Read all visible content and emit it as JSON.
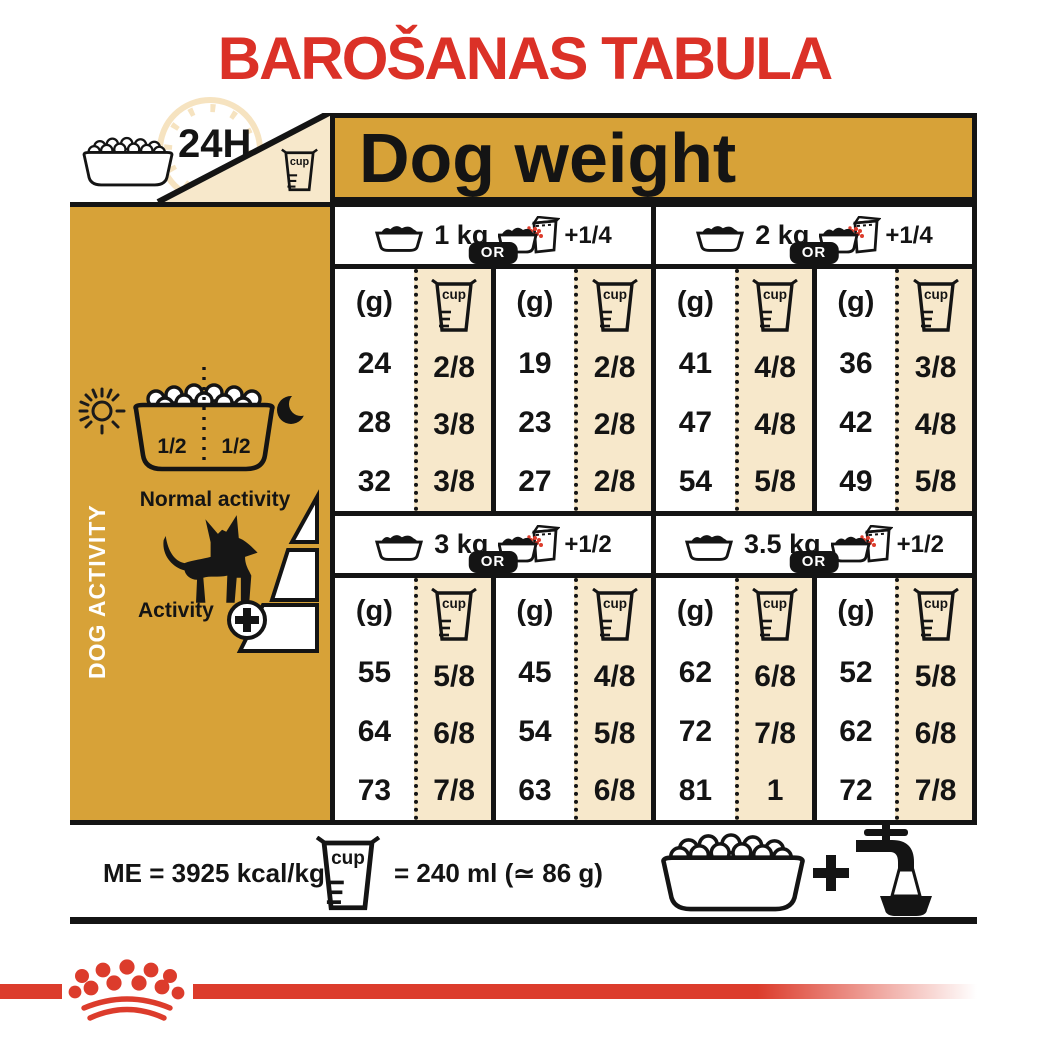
{
  "title": "BAROŠANAS TABULA",
  "top": {
    "hours": "24H",
    "dog_weight": "Dog weight"
  },
  "labels": {
    "cup": "cup",
    "or": "OR",
    "grams": "(g)"
  },
  "sidebar": {
    "title": "DOG ACTIVITY",
    "half_left": "1/2",
    "half_right": "1/2",
    "normal": "Normal activity",
    "active": "Activity"
  },
  "footer": {
    "me": "ME = 3925 kcal/kg",
    "cup_equiv": "= 240 ml (≃ 86 g)"
  },
  "colors": {
    "gold": "#D7A238",
    "cream": "#F7E8CB",
    "title_red": "#DB3127",
    "brand_red": "#DC3C2C",
    "ink": "#141414"
  },
  "chart_data": {
    "type": "table",
    "title": "BAROŠANAS TABULA",
    "header": "Dog weight",
    "row_meaning": "rows = dog activity level: normal activity, medium, activity + (high)",
    "column_meaning": "per weight: ration of kibble only (g / cup) OR kibble + 1/4 or 1/2 wet pouch (g / cup)",
    "cup_equivalence": "1 cup = 240 ml (≃ 86 g)",
    "metabolizable_energy": "ME = 3925 kcal/kg",
    "groups": [
      {
        "weight": "1 kg",
        "extra": "+1/4",
        "left": {
          "g": [
            "24",
            "28",
            "32"
          ],
          "cup": [
            "2/8",
            "3/8",
            "3/8"
          ]
        },
        "right": {
          "g": [
            "19",
            "23",
            "27"
          ],
          "cup": [
            "2/8",
            "2/8",
            "2/8"
          ]
        }
      },
      {
        "weight": "2 kg",
        "extra": "+1/4",
        "left": {
          "g": [
            "41",
            "47",
            "54"
          ],
          "cup": [
            "4/8",
            "4/8",
            "5/8"
          ]
        },
        "right": {
          "g": [
            "36",
            "42",
            "49"
          ],
          "cup": [
            "3/8",
            "4/8",
            "5/8"
          ]
        }
      },
      {
        "weight": "3 kg",
        "extra": "+1/2",
        "left": {
          "g": [
            "55",
            "64",
            "73"
          ],
          "cup": [
            "5/8",
            "6/8",
            "7/8"
          ]
        },
        "right": {
          "g": [
            "45",
            "54",
            "63"
          ],
          "cup": [
            "4/8",
            "5/8",
            "6/8"
          ]
        }
      },
      {
        "weight": "3.5 kg",
        "extra": "+1/2",
        "left": {
          "g": [
            "62",
            "72",
            "81"
          ],
          "cup": [
            "6/8",
            "7/8",
            "1"
          ]
        },
        "right": {
          "g": [
            "52",
            "62",
            "72"
          ],
          "cup": [
            "5/8",
            "6/8",
            "7/8"
          ]
        }
      }
    ]
  }
}
